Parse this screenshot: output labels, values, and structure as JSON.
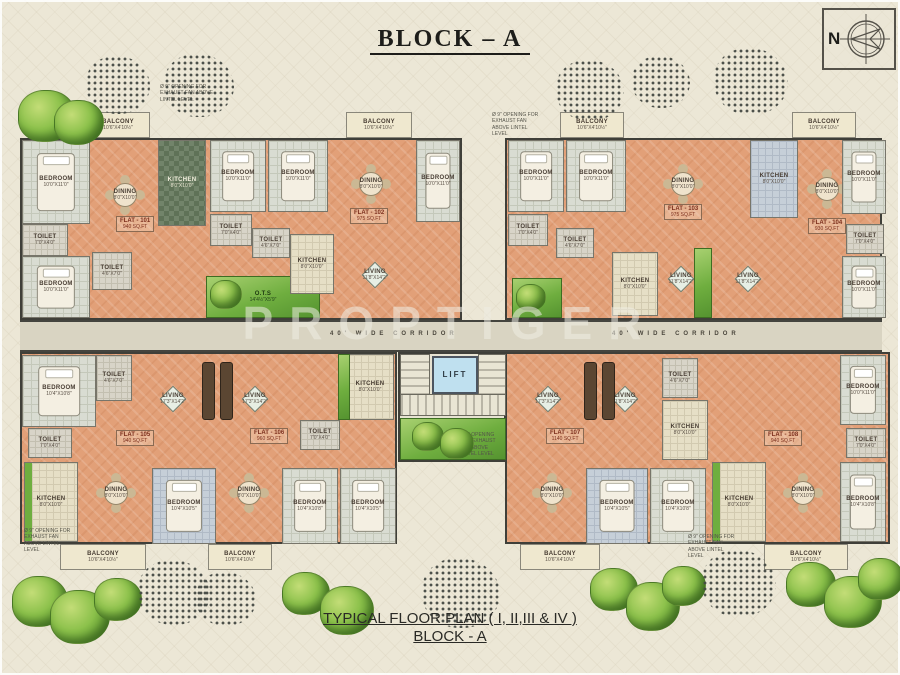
{
  "title": "BLOCK – A",
  "watermark": "PROPTIGER",
  "compass": {
    "n": "N"
  },
  "footer": {
    "line1": "TYPICAL FLOOR PLAN ( I, II,III & IV )",
    "line2": "BLOCK - A"
  },
  "corridor": {
    "label_left": "40' WIDE CORRIDOR",
    "label_right": "40' WIDE CORRIDOR"
  },
  "colors": {
    "background": "#ece7d6",
    "floor_salmon": "#e2a078",
    "floor_tile": "#d9dcd2",
    "kitchen_dark": "#5f7257",
    "balcony_cream": "#efe8cf",
    "garden_green": "#6fae3f",
    "wall": "#3f3f39",
    "lift_blue": "#bfe0ef",
    "corridor": "#d9d4c2"
  },
  "flats": [
    {
      "id": "FLAT - 101",
      "area": "940 SQ.FT",
      "x": 116,
      "y": 216
    },
    {
      "id": "FLAT - 102",
      "area": "975 SQ.FT",
      "x": 350,
      "y": 208
    },
    {
      "id": "FLAT - 103",
      "area": "975 SQ.FT",
      "x": 664,
      "y": 204
    },
    {
      "id": "FLAT - 104",
      "area": "930 SQ.FT",
      "x": 808,
      "y": 218
    },
    {
      "id": "FLAT - 105",
      "area": "940 SQ.FT",
      "x": 116,
      "y": 430
    },
    {
      "id": "FLAT - 106",
      "area": "960 SQ.FT",
      "x": 250,
      "y": 428
    },
    {
      "id": "FLAT - 107",
      "area": "1140 SQ.FT",
      "x": 546,
      "y": 428
    },
    {
      "id": "FLAT - 108",
      "area": "940 SQ.FT",
      "x": 764,
      "y": 430
    }
  ],
  "rooms": [
    {
      "name": "balcony",
      "label": "BALCONY",
      "dims": "10'6\"X4'10½\"",
      "x": 86,
      "y": 112,
      "w": 64,
      "h": 26,
      "fill": "cream"
    },
    {
      "name": "bedroom",
      "label": "BEDROOM",
      "dims": "10'0\"X11'0\"",
      "x": 22,
      "y": 140,
      "w": 68,
      "h": 84,
      "fill": "tile",
      "furniture": "bed"
    },
    {
      "name": "toilet",
      "label": "TOILET",
      "dims": "7'0\"X4'0\"",
      "x": 22,
      "y": 224,
      "w": 46,
      "h": 32,
      "fill": "toilet"
    },
    {
      "name": "bedroom",
      "label": "BEDROOM",
      "dims": "10'0\"X11'0\"",
      "x": 22,
      "y": 256,
      "w": 68,
      "h": 62,
      "fill": "tile",
      "furniture": "bed"
    },
    {
      "name": "dining",
      "label": "DINING",
      "dims": "8'0\"X10'0\"",
      "x": 92,
      "y": 140,
      "w": 66,
      "h": 110,
      "fill": "salmon",
      "furniture": "table-round"
    },
    {
      "name": "kitchen",
      "label": "KITCHEN",
      "dims": "8'0\"X10'0\"",
      "x": 158,
      "y": 140,
      "w": 48,
      "h": 86,
      "fill": "kdark"
    },
    {
      "name": "toilet",
      "label": "TOILET",
      "dims": "4'6\"X7'0\"",
      "x": 92,
      "y": 252,
      "w": 40,
      "h": 38,
      "fill": "toilet"
    },
    {
      "name": "ots-garden",
      "label": "O.T.S",
      "dims": "14'4½\"X5'9\"",
      "x": 206,
      "y": 276,
      "w": 114,
      "h": 42,
      "fill": "green"
    },
    {
      "name": "bedroom",
      "label": "BEDROOM",
      "dims": "10'0\"X11'0\"",
      "x": 210,
      "y": 140,
      "w": 56,
      "h": 72,
      "fill": "tile",
      "furniture": "bed"
    },
    {
      "name": "bedroom",
      "label": "BEDROOM",
      "dims": "10'0\"X11'0\"",
      "x": 268,
      "y": 140,
      "w": 60,
      "h": 72,
      "fill": "tile",
      "furniture": "bed"
    },
    {
      "name": "toilet",
      "label": "TOILET",
      "dims": "7'0\"X4'0\"",
      "x": 210,
      "y": 214,
      "w": 42,
      "h": 32,
      "fill": "toilet"
    },
    {
      "name": "toilet",
      "label": "TOILET",
      "dims": "4'6\"X7'0\"",
      "x": 252,
      "y": 228,
      "w": 38,
      "h": 30,
      "fill": "toilet"
    },
    {
      "name": "kitchen",
      "label": "KITCHEN",
      "dims": "8'0\"X10'0\"",
      "x": 290,
      "y": 234,
      "w": 44,
      "h": 60,
      "fill": "tan"
    },
    {
      "name": "balcony",
      "label": "BALCONY",
      "dims": "10'6\"X4'10½\"",
      "x": 346,
      "y": 112,
      "w": 66,
      "h": 26,
      "fill": "cream"
    },
    {
      "name": "dining",
      "label": "DINING",
      "dims": "8'0\"X10'0\"",
      "x": 340,
      "y": 140,
      "w": 62,
      "h": 88,
      "fill": "salmon",
      "furniture": "table-round"
    },
    {
      "name": "living",
      "label": "LIVING",
      "dims": "11'8\"X14'2\"",
      "x": 336,
      "y": 232,
      "w": 78,
      "h": 86,
      "fill": "salmon",
      "furniture": "table-diamond"
    },
    {
      "name": "bedroom",
      "label": "BEDROOM",
      "dims": "10'0\"X11'0\"",
      "x": 416,
      "y": 140,
      "w": 44,
      "h": 82,
      "fill": "tile",
      "furniture": "bed"
    },
    {
      "name": "balcony",
      "label": "BALCONY",
      "dims": "10'6\"X4'10½\"",
      "x": 560,
      "y": 112,
      "w": 64,
      "h": 26,
      "fill": "cream"
    },
    {
      "name": "balcony",
      "label": "BALCONY",
      "dims": "10'6\"X4'10½\"",
      "x": 792,
      "y": 112,
      "w": 64,
      "h": 26,
      "fill": "cream"
    },
    {
      "name": "bedroom",
      "label": "BEDROOM",
      "dims": "10'0\"X11'0\"",
      "x": 508,
      "y": 140,
      "w": 56,
      "h": 72,
      "fill": "tile",
      "furniture": "bed"
    },
    {
      "name": "bedroom",
      "label": "BEDROOM",
      "dims": "10'0\"X11'0\"",
      "x": 566,
      "y": 140,
      "w": 60,
      "h": 72,
      "fill": "tile",
      "furniture": "bed"
    },
    {
      "name": "dining",
      "label": "DINING",
      "dims": "8'0\"X10'0\"",
      "x": 652,
      "y": 140,
      "w": 62,
      "h": 88,
      "fill": "salmon",
      "furniture": "table-round"
    },
    {
      "name": "kitchen",
      "label": "KITCHEN",
      "dims": "8'0\"X10'0\"",
      "x": 750,
      "y": 140,
      "w": 48,
      "h": 78,
      "fill": "bluegray"
    },
    {
      "name": "dining",
      "label": "DINING",
      "dims": "8'0\"X10'0\"",
      "x": 800,
      "y": 158,
      "w": 54,
      "h": 62,
      "fill": "salmon",
      "furniture": "table-round"
    },
    {
      "name": "toilet",
      "label": "TOILET",
      "dims": "7'0\"X4'0\"",
      "x": 508,
      "y": 214,
      "w": 40,
      "h": 32,
      "fill": "toilet"
    },
    {
      "name": "toilet",
      "label": "TOILET",
      "dims": "4'6\"X7'0\"",
      "x": 556,
      "y": 228,
      "w": 38,
      "h": 30,
      "fill": "toilet"
    },
    {
      "name": "ots-garden",
      "label": "O.T.S",
      "x": 512,
      "y": 278,
      "w": 50,
      "h": 40,
      "fill": "green"
    },
    {
      "name": "kitchen",
      "label": "KITCHEN",
      "dims": "8'0\"X10'0\"",
      "x": 612,
      "y": 252,
      "w": 46,
      "h": 64,
      "fill": "tan"
    },
    {
      "name": "living",
      "label": "LIVING",
      "dims": "11'8\"X14'2\"",
      "x": 650,
      "y": 240,
      "w": 62,
      "h": 78,
      "fill": "salmon",
      "furniture": "table-diamond"
    },
    {
      "name": "living",
      "label": "LIVING",
      "dims": "11'8\"X14'2\"",
      "x": 716,
      "y": 240,
      "w": 64,
      "h": 78,
      "fill": "salmon",
      "furniture": "table-diamond"
    },
    {
      "name": "toilet",
      "label": "TOILET",
      "dims": "7'0\"X4'0\"",
      "x": 846,
      "y": 224,
      "w": 38,
      "h": 30,
      "fill": "toilet"
    },
    {
      "name": "bedroom",
      "label": "BEDROOM",
      "dims": "10'0\"X11'0\"",
      "x": 842,
      "y": 256,
      "w": 44,
      "h": 62,
      "fill": "tile",
      "furniture": "bed"
    },
    {
      "name": "garden-strip",
      "x": 694,
      "y": 248,
      "w": 18,
      "h": 70,
      "fill": "green"
    },
    {
      "name": "bedroom",
      "label": "BEDROOM",
      "dims": "10'0\"X11'0\"",
      "x": 842,
      "y": 140,
      "w": 44,
      "h": 74,
      "fill": "tile",
      "furniture": "bed"
    },
    {
      "name": "bedroom",
      "label": "BEDROOM",
      "dims": "10'4\"X10'8\"",
      "x": 22,
      "y": 355,
      "w": 74,
      "h": 72,
      "fill": "tile",
      "furniture": "bed"
    },
    {
      "name": "toilet",
      "label": "TOILET",
      "dims": "4'6\"X7'0\"",
      "x": 96,
      "y": 355,
      "w": 36,
      "h": 46,
      "fill": "toilet"
    },
    {
      "name": "living",
      "label": "LIVING",
      "dims": "17'3\"X14'2\"",
      "x": 132,
      "y": 355,
      "w": 82,
      "h": 88,
      "fill": "salmon",
      "furniture": "table-diamond"
    },
    {
      "name": "living",
      "label": "LIVING",
      "dims": "17'3\"X14'2\"",
      "x": 214,
      "y": 355,
      "w": 82,
      "h": 88,
      "fill": "salmon",
      "furniture": "table-diamond"
    },
    {
      "name": "toilet",
      "label": "TOILET",
      "dims": "7'0\"X4'0\"",
      "x": 28,
      "y": 428,
      "w": 44,
      "h": 30,
      "fill": "toilet"
    },
    {
      "name": "kitchen",
      "label": "KITCHEN",
      "dims": "8'0\"X10'0\"",
      "x": 24,
      "y": 462,
      "w": 54,
      "h": 80,
      "fill": "tangreen"
    },
    {
      "name": "dining",
      "label": "DINING",
      "dims": "8'0\"X10'0\"",
      "x": 84,
      "y": 452,
      "w": 64,
      "h": 82,
      "fill": "salmon",
      "furniture": "table-round"
    },
    {
      "name": "bedroom",
      "label": "BEDROOM",
      "dims": "10'4\"X10'5\"",
      "x": 152,
      "y": 468,
      "w": 64,
      "h": 76,
      "fill": "bluegray",
      "furniture": "bed"
    },
    {
      "name": "dining",
      "label": "DINING",
      "dims": "8'0\"X10'0\"",
      "x": 218,
      "y": 452,
      "w": 62,
      "h": 82,
      "fill": "salmon",
      "furniture": "table-round"
    },
    {
      "name": "bedroom",
      "label": "BEDROOM",
      "dims": "10'4\"X10'8\"",
      "x": 282,
      "y": 468,
      "w": 56,
      "h": 76,
      "fill": "tile",
      "furniture": "bed"
    },
    {
      "name": "bedroom",
      "label": "BEDROOM",
      "dims": "10'4\"X10'5\"",
      "x": 340,
      "y": 468,
      "w": 56,
      "h": 76,
      "fill": "tile",
      "furniture": "bed"
    },
    {
      "name": "toilet",
      "label": "TOILET",
      "dims": "7'0\"X4'0\"",
      "x": 300,
      "y": 420,
      "w": 40,
      "h": 30,
      "fill": "toilet"
    },
    {
      "name": "kitchen",
      "label": "KITCHEN",
      "dims": "8'0\"X10'0\"",
      "x": 346,
      "y": 354,
      "w": 48,
      "h": 66,
      "fill": "tan"
    },
    {
      "name": "garden-strip",
      "x": 338,
      "y": 354,
      "w": 12,
      "h": 66,
      "fill": "green"
    },
    {
      "name": "balcony",
      "label": "BALCONY",
      "dims": "10'6\"X4'10½\"",
      "x": 60,
      "y": 544,
      "w": 86,
      "h": 26,
      "fill": "cream"
    },
    {
      "name": "balcony",
      "label": "BALCONY",
      "dims": "10'6\"X4'10½\"",
      "x": 208,
      "y": 544,
      "w": 64,
      "h": 26,
      "fill": "cream"
    },
    {
      "name": "wardrobe",
      "x": 202,
      "y": 362,
      "w": 13,
      "h": 58,
      "fill": "block"
    },
    {
      "name": "wardrobe",
      "x": 220,
      "y": 362,
      "w": 13,
      "h": 58,
      "fill": "block"
    },
    {
      "name": "living",
      "label": "LIVING",
      "dims": "17'3\"X14'2\"",
      "x": 508,
      "y": 355,
      "w": 80,
      "h": 88,
      "fill": "salmon",
      "furniture": "table-diamond"
    },
    {
      "name": "living",
      "label": "LIVING",
      "dims": "11'8\"X14'2\"",
      "x": 590,
      "y": 355,
      "w": 70,
      "h": 88,
      "fill": "salmon",
      "furniture": "table-diamond"
    },
    {
      "name": "toilet",
      "label": "TOILET",
      "dims": "4'6\"X7'0\"",
      "x": 662,
      "y": 358,
      "w": 36,
      "h": 40,
      "fill": "toilet"
    },
    {
      "name": "kitchen",
      "label": "KITCHEN",
      "dims": "8'0\"X10'0\"",
      "x": 662,
      "y": 400,
      "w": 46,
      "h": 60,
      "fill": "tan"
    },
    {
      "name": "dining",
      "label": "DINING",
      "dims": "8'0\"X10'0\"",
      "x": 520,
      "y": 452,
      "w": 64,
      "h": 82,
      "fill": "salmon",
      "furniture": "table-round"
    },
    {
      "name": "bedroom",
      "label": "BEDROOM",
      "dims": "10'4\"X10'5\"",
      "x": 586,
      "y": 468,
      "w": 62,
      "h": 76,
      "fill": "bluegray",
      "furniture": "bed"
    },
    {
      "name": "bedroom",
      "label": "BEDROOM",
      "dims": "10'4\"X10'8\"",
      "x": 650,
      "y": 468,
      "w": 56,
      "h": 76,
      "fill": "tile",
      "furniture": "bed"
    },
    {
      "name": "kitchen",
      "label": "KITCHEN",
      "dims": "8'0\"X10'0\"",
      "x": 712,
      "y": 462,
      "w": 54,
      "h": 80,
      "fill": "tangreen"
    },
    {
      "name": "dining",
      "label": "DINING",
      "dims": "8'0\"X10'0\"",
      "x": 770,
      "y": 452,
      "w": 66,
      "h": 82,
      "fill": "salmon",
      "furniture": "table-round"
    },
    {
      "name": "bedroom",
      "label": "BEDROOM",
      "dims": "10'4\"X10'8\"",
      "x": 840,
      "y": 462,
      "w": 46,
      "h": 80,
      "fill": "tile",
      "furniture": "bed"
    },
    {
      "name": "toilet",
      "label": "TOILET",
      "dims": "7'0\"X4'0\"",
      "x": 846,
      "y": 428,
      "w": 40,
      "h": 30,
      "fill": "toilet"
    },
    {
      "name": "bedroom",
      "label": "BEDROOM",
      "dims": "10'0\"X11'0\"",
      "x": 840,
      "y": 355,
      "w": 46,
      "h": 70,
      "fill": "tile",
      "furniture": "bed"
    },
    {
      "name": "balcony",
      "label": "BALCONY",
      "dims": "10'6\"X4'10½\"",
      "x": 520,
      "y": 544,
      "w": 80,
      "h": 26,
      "fill": "cream"
    },
    {
      "name": "balcony",
      "label": "BALCONY",
      "dims": "10'6\"X4'10½\"",
      "x": 764,
      "y": 544,
      "w": 84,
      "h": 26,
      "fill": "cream"
    },
    {
      "name": "wardrobe",
      "x": 584,
      "y": 362,
      "w": 13,
      "h": 58,
      "fill": "block"
    },
    {
      "name": "wardrobe",
      "x": 602,
      "y": 362,
      "w": 13,
      "h": 58,
      "fill": "block"
    },
    {
      "name": "stairs",
      "x": 400,
      "y": 354,
      "w": 30,
      "h": 58,
      "fill": "stairs"
    },
    {
      "name": "lift",
      "label": "LIFT",
      "x": 432,
      "y": 356,
      "w": 46,
      "h": 38,
      "fill": "lift"
    },
    {
      "name": "stairs",
      "x": 478,
      "y": 354,
      "w": 28,
      "h": 58,
      "fill": "stairs"
    },
    {
      "name": "stair-landing",
      "x": 400,
      "y": 394,
      "w": 106,
      "h": 22,
      "fill": "stairsh"
    },
    {
      "name": "ots-garden",
      "label": "O.T.S.",
      "x": 400,
      "y": 418,
      "w": 106,
      "h": 42,
      "fill": "green"
    }
  ],
  "trees": [
    {
      "t": "tree",
      "x": 18,
      "y": 90,
      "s": 56
    },
    {
      "t": "tree",
      "x": 54,
      "y": 100,
      "s": 48
    },
    {
      "t": "bush",
      "x": 86,
      "y": 56,
      "s": 64
    },
    {
      "t": "bush",
      "x": 164,
      "y": 54,
      "s": 70
    },
    {
      "t": "bush",
      "x": 556,
      "y": 60,
      "s": 68
    },
    {
      "t": "bush",
      "x": 632,
      "y": 56,
      "s": 58
    },
    {
      "t": "bush",
      "x": 714,
      "y": 48,
      "s": 74
    },
    {
      "t": "tree",
      "x": 12,
      "y": 576,
      "s": 54
    },
    {
      "t": "tree",
      "x": 50,
      "y": 590,
      "s": 58
    },
    {
      "t": "tree",
      "x": 94,
      "y": 578,
      "s": 46
    },
    {
      "t": "bush",
      "x": 138,
      "y": 560,
      "s": 72
    },
    {
      "t": "bush",
      "x": 196,
      "y": 572,
      "s": 60
    },
    {
      "t": "tree",
      "x": 282,
      "y": 572,
      "s": 46
    },
    {
      "t": "tree",
      "x": 320,
      "y": 586,
      "s": 52
    },
    {
      "t": "bush",
      "x": 422,
      "y": 558,
      "s": 78
    },
    {
      "t": "tree",
      "x": 590,
      "y": 568,
      "s": 46
    },
    {
      "t": "tree",
      "x": 626,
      "y": 582,
      "s": 52
    },
    {
      "t": "tree",
      "x": 662,
      "y": 566,
      "s": 42
    },
    {
      "t": "bush",
      "x": 702,
      "y": 550,
      "s": 74
    },
    {
      "t": "tree",
      "x": 786,
      "y": 562,
      "s": 48
    },
    {
      "t": "tree",
      "x": 824,
      "y": 576,
      "s": 56
    },
    {
      "t": "tree",
      "x": 858,
      "y": 558,
      "s": 44
    },
    {
      "t": "tree",
      "x": 210,
      "y": 280,
      "s": 30
    },
    {
      "t": "tree",
      "x": 516,
      "y": 284,
      "s": 28
    },
    {
      "t": "tree",
      "x": 412,
      "y": 422,
      "s": 30
    },
    {
      "t": "tree",
      "x": 440,
      "y": 428,
      "s": 32
    }
  ],
  "annotations": [
    {
      "x": 160,
      "y": 84,
      "w": 56,
      "text": "Ø 9\" OPENING FOR EXHAUST FAN ABOVE LINTEL LEVEL"
    },
    {
      "x": 492,
      "y": 112,
      "w": 52,
      "text": "Ø 9\" OPENING FOR EXHAUST FAN ABOVE LINTEL LEVEL"
    },
    {
      "x": 24,
      "y": 528,
      "w": 50,
      "text": "Ø 9\" OPENING FOR EXHAUST FAN ABOVE LINTEL LEVEL"
    },
    {
      "x": 688,
      "y": 534,
      "w": 52,
      "text": "Ø 9\" OPENING FOR EXHAUST FAN ABOVE LINTEL LEVEL"
    },
    {
      "x": 460,
      "y": 432,
      "w": 44,
      "text": "Ø 9\" OPENING FOR EXHAUST FAN ABOVE LINTEL LEVEL"
    }
  ]
}
